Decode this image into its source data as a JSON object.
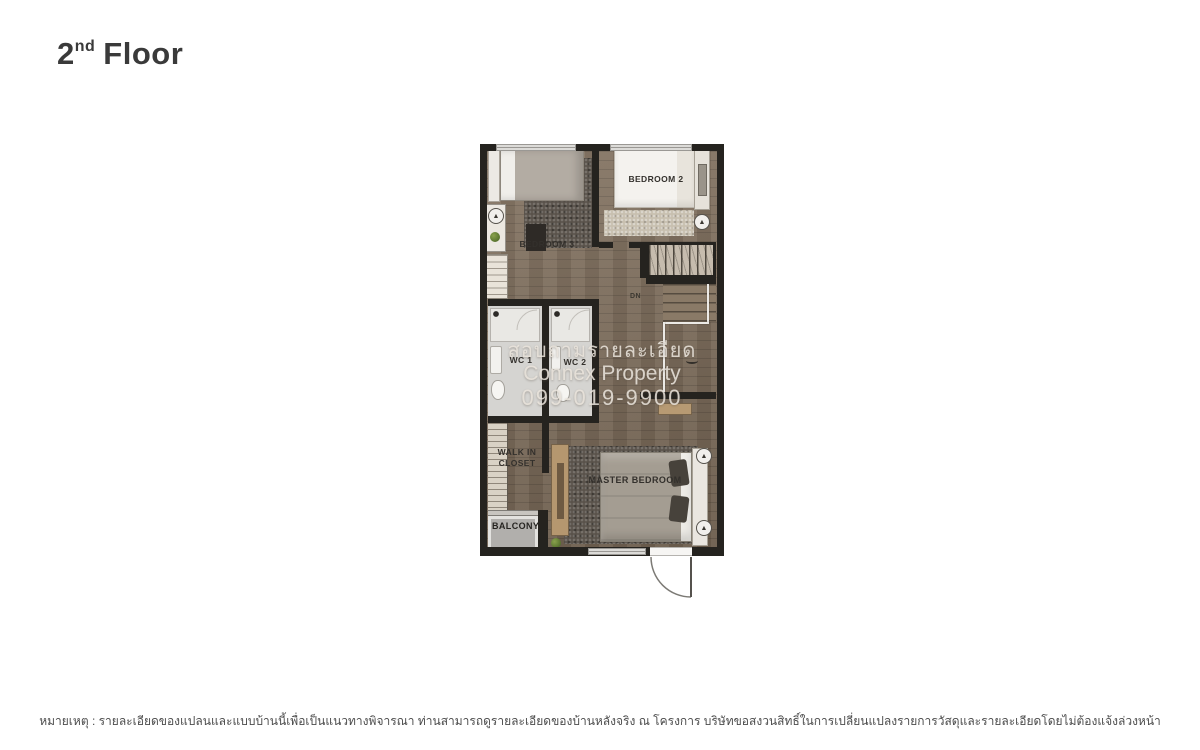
{
  "title": {
    "number": "2",
    "ordinal": "nd",
    "word": "Floor"
  },
  "floorplan": {
    "labels": {
      "bedroom2": "BEDROOM 2",
      "bedroom3": "BEDROOM 3",
      "wc1": "WC 1",
      "wc2": "WC 2",
      "walk_in_line1": "WALK IN",
      "walk_in_line2": "CLOSET",
      "master_bedroom": "MASTER BEDROOM",
      "balcony": "BALCONY",
      "stairs_down": "DN"
    },
    "watermark": {
      "line1": "สอบถามรายละเอียด",
      "line2": "Connex Property",
      "line3": "099-019-9900"
    },
    "icons": {
      "ac_glyph": "▲"
    }
  },
  "disclaimer": "หมายเหตุ : รายละเอียดของแปลนและแบบบ้านนี้เพื่อเป็นแนวทางพิจารณา ท่านสามารถดูรายละเอียดของบ้านหลังจริง ณ โครงการ บริษัทขอสงวนสิทธิ์ในการเปลี่ยนแปลงรายการวัสดุและรายละเอียดโดยไม่ต้องแจ้งล่วงหน้า",
  "palette": {
    "wall": "#25231f",
    "wood_floor": "#7c6b59",
    "wc_floor": "#d5d4d1",
    "rug_dark": "#5a534b",
    "rug_light": "#c8c0b0",
    "furniture_wood": "#b79a73",
    "watermark_text": "#ece6de",
    "title_text": "#3a3a3a"
  }
}
